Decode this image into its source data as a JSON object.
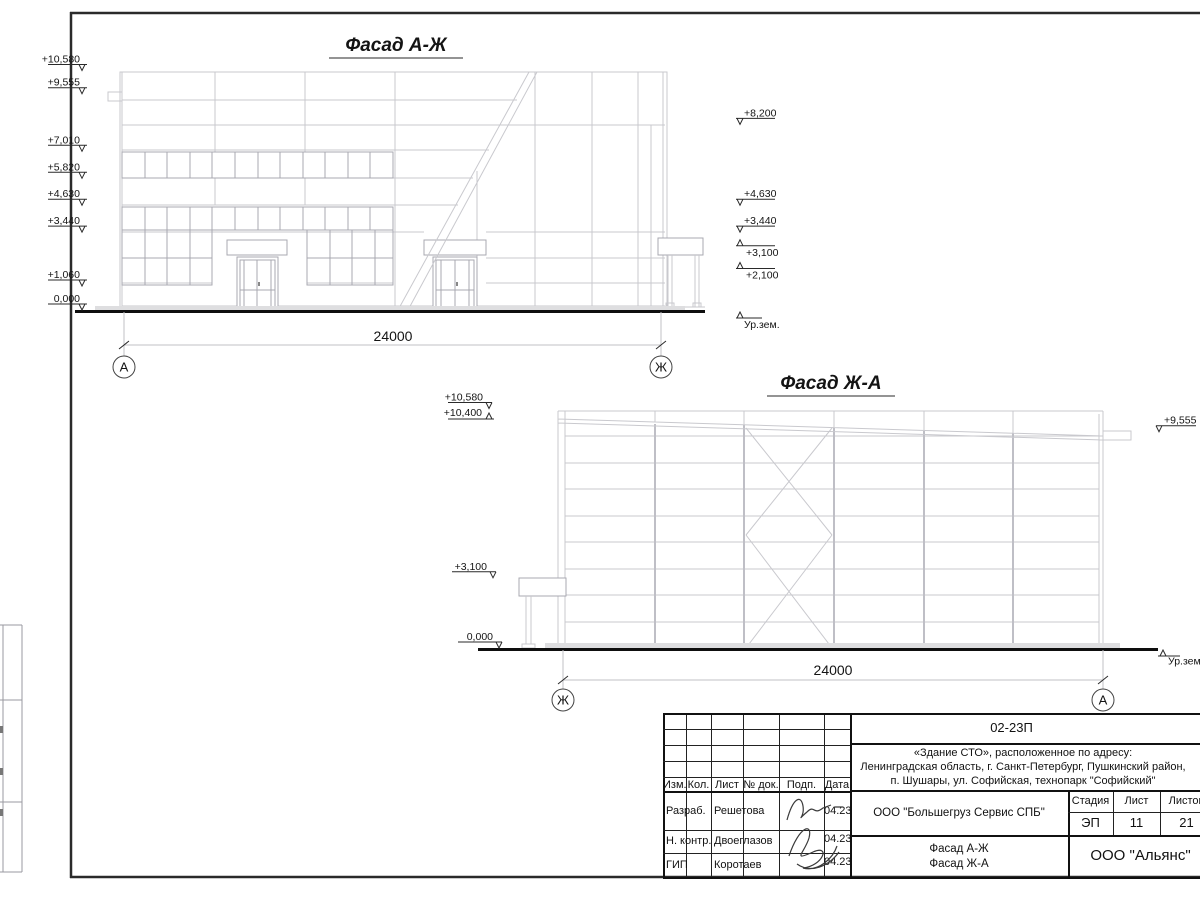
{
  "drawing": {
    "facade_aj": {
      "title": "Фасад А-Ж",
      "dimension": "24000",
      "axis_left": "А",
      "axis_right": "Ж",
      "levels_left": [
        "+10,580",
        "+9,555",
        "+7,010",
        "+5,820",
        "+4,630",
        "+3,440",
        "+1,060",
        "0,000"
      ],
      "levels_right": [
        "+8,200",
        "+4,630",
        "+3,440",
        "+3,100",
        "+2,100"
      ],
      "ground": "Ур.зем."
    },
    "facade_ja": {
      "title": "Фасад Ж-А",
      "dimension": "24000",
      "axis_left": "Ж",
      "axis_right": "А",
      "levels_left": [
        "+10,580",
        "+10,400",
        "+3,100",
        "0,000"
      ],
      "levels_right": [
        "+9,555"
      ],
      "ground": "Ур.зем."
    }
  },
  "titleblock": {
    "code": "02-23П",
    "address_lines": [
      "«Здание СТО», расположенное по адресу:",
      "Ленинградская область, г. Санкт-Петербург, Пушкинский район,",
      "п. Шушары, ул. Софийская, технопарк \"Софийский\""
    ],
    "columns": [
      "Изм.",
      "Кол.",
      "Лист",
      "№ док.",
      "Подп.",
      "Дата"
    ],
    "rows": [
      {
        "role": "Разраб.",
        "name": "Решетова",
        "date": "04.23"
      },
      {
        "role": "Н. контр.",
        "name": "Двоеглазов",
        "date": "04.23"
      },
      {
        "role": "ГИП",
        "name": "Коротаев",
        "date": "04.23"
      }
    ],
    "client": "ООО \"Большегруз Сервис СПБ\"",
    "stage_label": "Стадия",
    "stage": "ЭП",
    "sheet_label": "Лист",
    "sheet": "11",
    "sheets_label": "Листов",
    "sheets": "21",
    "content_line1": "Фасад А-Ж",
    "content_line2": "Фасад Ж-А",
    "org": "ООО \"Альянс\""
  }
}
